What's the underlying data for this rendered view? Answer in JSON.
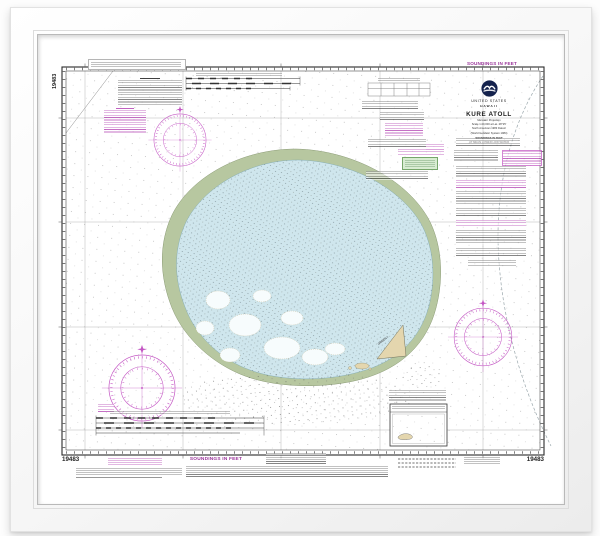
{
  "print": {
    "kind": "framed nautical chart print",
    "frame_color": "#ffffff",
    "mat_color": "#ffffff"
  },
  "chart": {
    "number": "19483",
    "top_note": "SOUNDINGS IN FEET",
    "bottom_note": "SOUNDINGS IN FEET",
    "title_block": {
      "logo_icon": "noaa-logo",
      "country": "UNITED STATES",
      "region": "HAWAII",
      "title": "KURE ATOLL",
      "detail_lines": [
        "Mercator Projection",
        "Scale 1:20,000 at Lat. 28°25'",
        "North American 1983 Datum",
        "(World Geodetic System 1984)",
        "SOUNDINGS IN FEET",
        "AT MEAN LOWER LOW WATER"
      ]
    },
    "labels": {
      "island": "GREEN I."
    },
    "corner_numbers": {
      "left_margin": "19483",
      "bottom_left": "19483",
      "bottom_right": "19483"
    },
    "colors": {
      "lagoon": "#cfe6ed",
      "reef_flat": "#b7c7a0",
      "sand": "#e4d6ae",
      "chart_magenta": "#c457c4",
      "note_purple": "#993399",
      "highlight_green": "#d8ecd2",
      "noaa_navy": "#14224d"
    }
  }
}
